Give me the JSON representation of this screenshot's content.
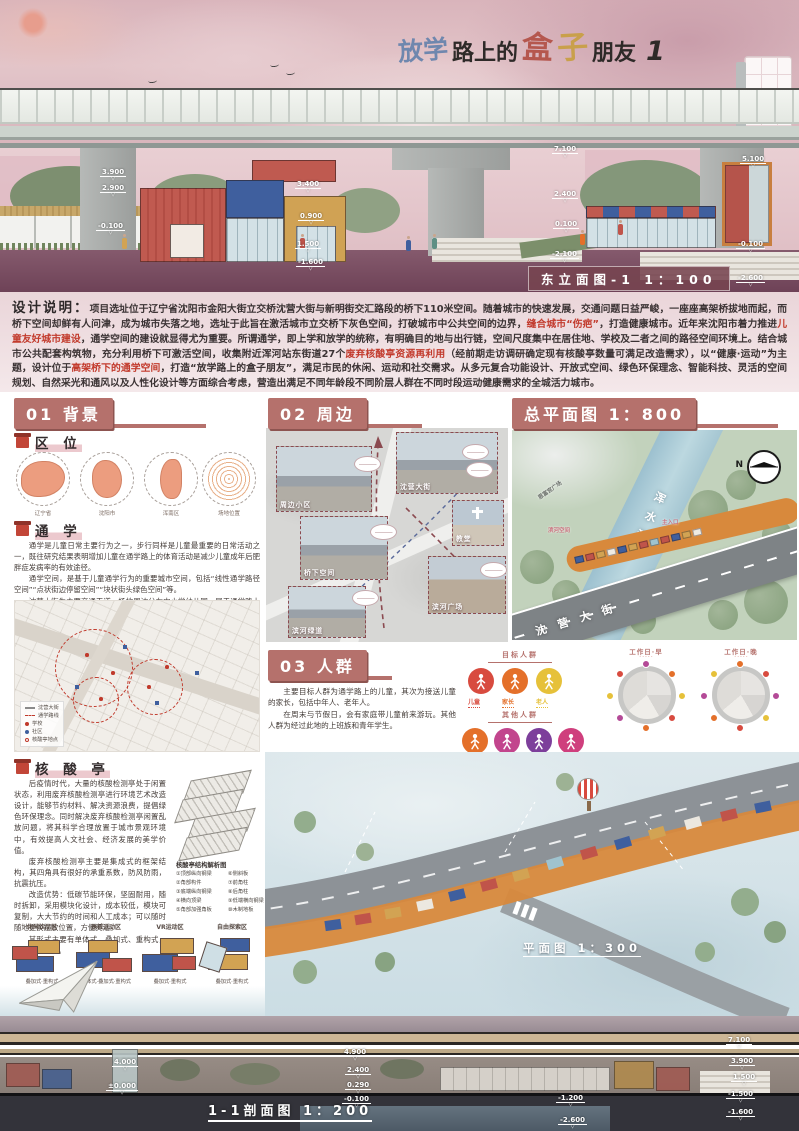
{
  "colors": {
    "accent": "#b5716c",
    "highlight_red": "#c23a2c",
    "container_red": "#c0544a",
    "container_blue": "#3f5f9e",
    "container_gold": "#d2a353",
    "path_orange": "#d8893c",
    "title_blue": "#6f87ae",
    "title_red": "#b5574e",
    "title_gold": "#c9a04b"
  },
  "header": {
    "title": {
      "t1": "放学",
      "t2": "路上的",
      "t3": "盒",
      "t4": "子",
      "t5": "朋友",
      "t6": "1"
    }
  },
  "east_elevation": {
    "caption": "东立面图-1 1：100",
    "dims": [
      "3.900",
      "2.900",
      "-0.100",
      "3.400",
      "0.900",
      "1.500",
      "-1.600",
      "7.100",
      "2.400",
      "0.100",
      "-2.100",
      "5.100",
      "-0.100",
      "-2.600"
    ]
  },
  "description": {
    "label": "设计说明：",
    "s1": "项目选址位于辽宁省沈阳市金阳大街立交桥沈营大街与新明街交汇路段的桥下110米空间。随着城市的快速发展，交通问题日益严峻，一座座高架桥拔地而起，而桥下空间却鲜有人问津，成为城市失落之地，选址于此旨在激活城市立交桥下灰色空间，打破城市中公共空间的边界，",
    "s2": "缝合城市“伤疤”",
    "s3": "，打造健康城市。近年来沈阳市着力推进",
    "s4": "儿童友好城市建设",
    "s5": "，通学空间的建设就显得尤为重要。所谓通学，即上学和放学的统称，有明确目的地与出行链，空间尺度集中在居住地、学校及二者之间的路径空间环境上。结合城市公共配套构筑物，充分利用桥下可激活空间，收集附近浑河站东街道27个",
    "s6": "废弃核酸亭资源再利用",
    "s7": "（经前期走访调研确定现有核酸亭数量可满足改造需求），以“健康·运动”为主题，设计位于",
    "s8": "高架桥下的通学空间",
    "s9": "，打造“放学路上的盒子朋友”，满足市民的休闲、运动和社交需求。从多元复合功能设计、开放式空间、绿色环保理念、智能科技、灵活的空间规划、自然采光和通风以及人性化设计等方面综合考虑，营造出满足不同年龄段不同阶层人群在不同时段运动健康需求的全城活力城市。"
  },
  "s01": {
    "header": "01 背景",
    "quwei": {
      "title": "区 位",
      "maps": [
        "辽宁省",
        "沈阳市",
        "浑南区",
        "场地位置"
      ]
    },
    "tongxue": {
      "title": "通 学",
      "p1": "通学是儿童日常主要行为之一，步行同样是儿童最重要的日常活动之一，既往研究结果表明增加儿童在通学路上的体育活动是减少儿童成年后肥胖症发病率的有效途径。",
      "p2": "通学空间，是基于儿童通学行为的重要城市空间，包括“线性通学路径空间”“点状街边停留空间”“块状街头绿色空间”等。",
      "p3": "沈营大街为主要交通干道，场地周边分布中小学幼儿园，属于通学路上的最后一公里，是带状通学空间的最佳选择。",
      "legend": [
        "沈营大街",
        "通学路线",
        "学校",
        "社区",
        "核酸亭地点"
      ]
    },
    "hesuanting": {
      "title": "核 酸 亭",
      "p1": "后疫情时代，大量的核酸检测亭处于闲置状态，利用废弃核酸检测亭进行环境艺术改造设计，能够节约材料、解决资源浪费，提倡绿色环保理念。同时解决废弃核酸检测亭闲置乱放问题，将其科学合理放置于城市景观环境中，有效提高人文社会、经济发展的美学价值。",
      "p2": "废弃核酸检测亭主要是集成式的框架结构，其四角具有很好的承重系数，防风防雨，抗震抗压。",
      "p3": "改造优势：低碳节能环保，坚固耐用，随时拆卸，采用模块化设计，成本较低，模块可复制，大大节约的时间和人工成本；可以随时随地更换摆放位置，方便灵活。",
      "p4": "其形式主要有单体式、叠加式、重构式，组合方式如下。",
      "diagram_title": "核酸亭结构解析图",
      "legend_left": [
        "①顶部纵向钢梁",
        "②角部构件",
        "③底端纵向钢梁",
        "④横向顶梁",
        "⑤角部加强角板"
      ],
      "legend_right": [
        "⑥侧斜板",
        "⑦前角柱",
        "⑧后角柱",
        "⑨低端横向钢梁",
        "⑩木制地板"
      ]
    },
    "zones": [
      {
        "name": "休闲饮品区",
        "mode": "叠加式·重构式"
      },
      {
        "name": "器械运动区",
        "mode": "单体式·叠加式·重构式"
      },
      {
        "name": "VR运动区",
        "mode": "叠加式·重构式"
      },
      {
        "name": "自由探索区",
        "mode": "叠加式·重构式"
      }
    ]
  },
  "s02": {
    "header": "02 周边",
    "photos": [
      "周边小区",
      "沈营大街",
      "桥下空间",
      "滨河绿道",
      "教堂",
      "滨河广场"
    ]
  },
  "s03": {
    "header": "03 人群",
    "p1": "主要目标人群为通学路上的儿童，其次为接送儿童的家长，包括中年人、老年人。",
    "p2": "在周末与节假日，会有家庭带儿童前来游玩。其他人群为经过此地的上班族和青年学生。",
    "target_title": "目标人群",
    "target": [
      {
        "label": "儿童",
        "color": "#d84b3f"
      },
      {
        "label": "家长",
        "color": "#e4702a"
      },
      {
        "label": "老人",
        "color": "#e6c13a"
      }
    ],
    "other_title": "其他人群",
    "other": [
      {
        "label": "上班族",
        "color": "#e4702a"
      },
      {
        "label": "青年学生",
        "color": "#b44a97"
      },
      {
        "label": "其他路人",
        "color": "#8d4b9f"
      }
    ],
    "other_icon_colors": [
      "#e4702a",
      "#c2458d",
      "#7d3f9b",
      "#cf3f7d"
    ],
    "clocks": [
      {
        "title": "工作日·早",
        "sub": ""
      },
      {
        "title": "工作日·晚",
        "sub": ""
      },
      {
        "title": "周末与假日",
        "sub": "All through the day"
      }
    ]
  },
  "master_plan": {
    "header": "总平面图 1：800",
    "river": "浑水河",
    "street1": "沈营大街",
    "street2": "新明街",
    "plaza": "恩富宫广场",
    "label1": "滨河空间",
    "label2": "主入口",
    "north": "N"
  },
  "plan": {
    "caption": "平面图 1：300"
  },
  "section11": {
    "caption": "1-1剖面图 1：200",
    "dims": [
      "4.000",
      "±0.000",
      "4.900",
      "2.400",
      "0.290",
      "-0.100",
      "-1.200",
      "-2.600",
      "7.100",
      "3.900",
      "1.500",
      "-1.500",
      "-1.600"
    ]
  }
}
